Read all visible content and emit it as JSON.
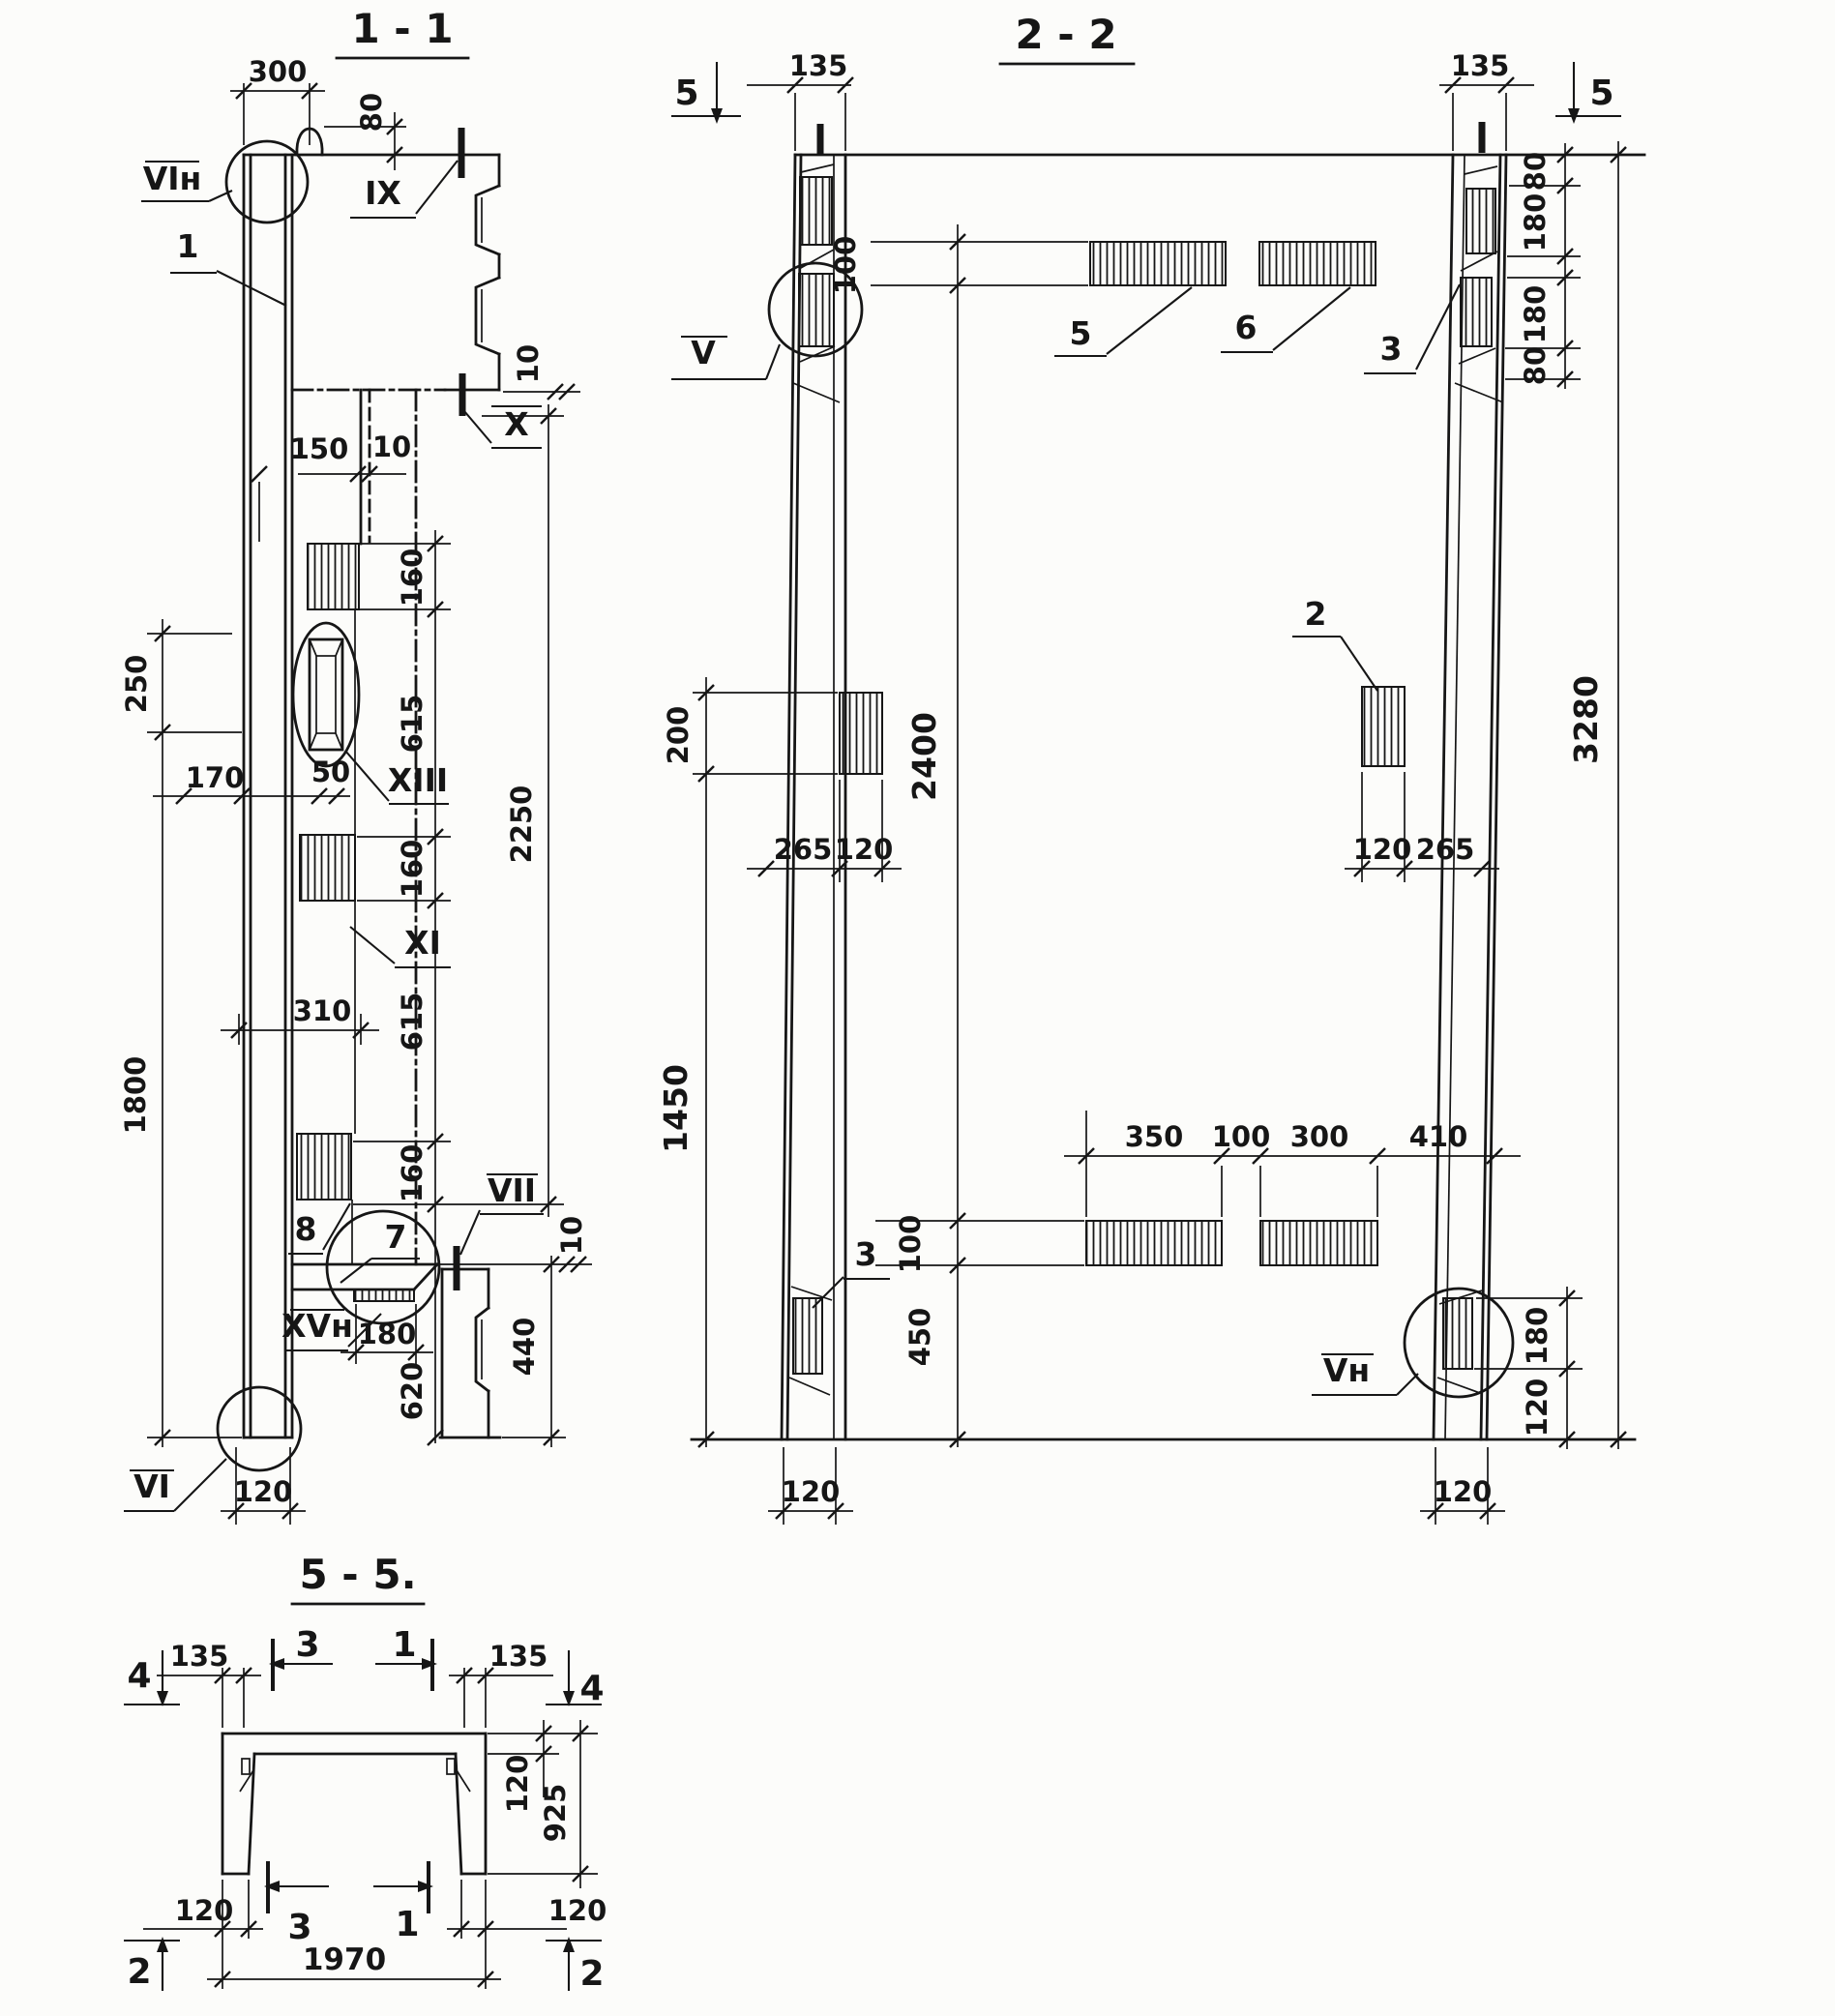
{
  "sheet": {
    "background": "#fcfcfa",
    "ink": "#161616"
  },
  "sections": {
    "s11": {
      "title": "1 - 1",
      "labels": {
        "vin": "VIн",
        "one": "1",
        "ix": "IX",
        "x": "X",
        "xiii": "XIII",
        "xi": "XI",
        "eight": "8",
        "seven": "7",
        "vii": "VII",
        "xvn": "XVн",
        "vi": "VI"
      },
      "dims": {
        "w300": "300",
        "h80": "80",
        "s10": "10",
        "w150": "150",
        "g10": "10",
        "r160a": "160",
        "r615a": "615",
        "r160b": "160",
        "r615b": "615",
        "r160c": "160",
        "r620": "620",
        "t2250": "2250",
        "l250": "250",
        "l170": "170",
        "l50": "50",
        "l310": "310",
        "l1800": "1800",
        "b180": "180",
        "b440": "440",
        "b10": "10",
        "b120": "120"
      }
    },
    "s22": {
      "title": "2 - 2",
      "labels": {
        "mk5l": "5",
        "mk5r": "5",
        "v": "V",
        "vn": "Vн",
        "p5": "5",
        "p6": "6",
        "p3r": "3",
        "p3l": "3",
        "p2": "2"
      },
      "dims": {
        "tl135": "135",
        "tr135": "135",
        "rc80a": "80",
        "rc180a": "180",
        "rc180b": "180",
        "rc80b": "80",
        "r3280": "3280",
        "c100t": "100",
        "c2400": "2400",
        "c100b": "100",
        "c450": "450",
        "l200": "200",
        "l1450": "1450",
        "lm265": "265",
        "lm120": "120",
        "rm120": "120",
        "rm265": "265",
        "bc350": "350",
        "bc100": "100",
        "bc300": "300",
        "bc410": "410",
        "rb180": "180",
        "rb120": "120",
        "bl120": "120",
        "br120": "120"
      }
    },
    "s55": {
      "title": "5 - 5.",
      "labels": {
        "m4l": "4",
        "m4r": "4",
        "m3t": "3",
        "m1t": "1",
        "m3b": "3",
        "m1b": "1",
        "m2l": "2",
        "m2r": "2"
      },
      "dims": {
        "l135": "135",
        "r135": "135",
        "f120": "120",
        "h925": "925",
        "bl120": "120",
        "br120": "120",
        "w1970": "1970"
      }
    }
  }
}
